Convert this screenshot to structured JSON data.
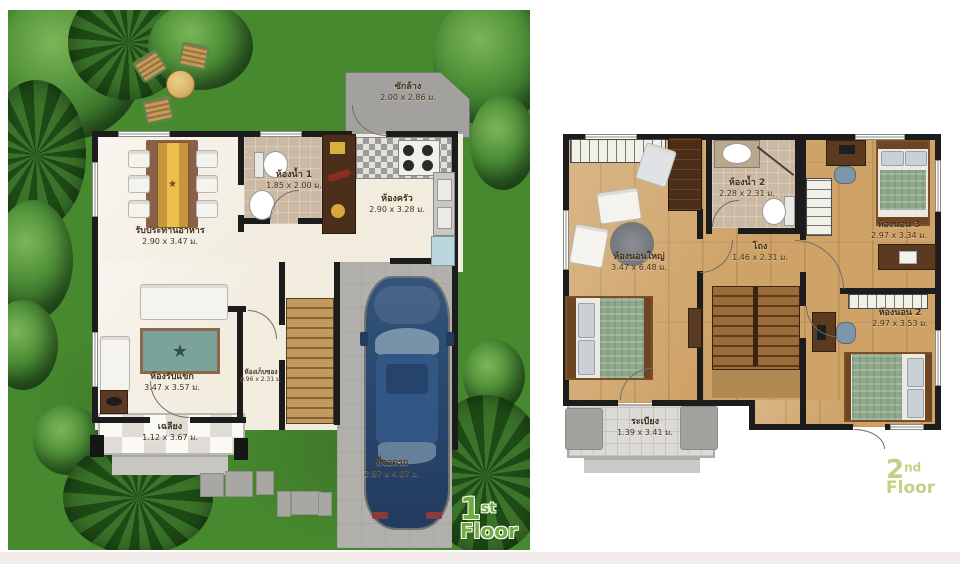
{
  "title": "House floor plans",
  "colors": {
    "garden_green": "#47892f",
    "tree_dark": "#2c5a1f",
    "wall_black": "#1c1c1c",
    "wood_floor_tan": "#cfa368",
    "cream_floor": "#f2ecdf",
    "bath_tile_beige": "#cbb9a3",
    "concrete_gray": "#b2b0ad",
    "car_blue": "#2b4a70",
    "label_brown": "#46311a",
    "floor1_tag_green": "#71ad3e",
    "floor2_tag_green": "#c2d284"
  },
  "floor1": {
    "tag": {
      "number": "1",
      "ordinal": "st",
      "word": "Floor"
    },
    "rooms": {
      "laundry": {
        "name": "ซักล้าง",
        "dims": "2.00 x 2.86 ม."
      },
      "bath1": {
        "name": "ห้องน้ำ 1",
        "dims": "1.85 x 2.00 ม."
      },
      "kitchen": {
        "name": "ห้องครัว",
        "dims": "2.90 x 3.28 ม."
      },
      "dining": {
        "name": "รับประทานอาหาร",
        "dims": "2.90 x 3.47 ม."
      },
      "living": {
        "name": "ห้องรับแขก",
        "dims": "3.47 x 3.57 ม."
      },
      "storage": {
        "name": "ห้องเก็บของ",
        "dims": "0.96 x 2.31 ม."
      },
      "terrace": {
        "name": "เฉลียง",
        "dims": "1.12 x 3.67 ม."
      },
      "carport": {
        "name": "ที่จอดรถ",
        "dims": "2.97 x 4.07 ม."
      }
    }
  },
  "floor2": {
    "tag": {
      "number": "2",
      "ordinal": "nd",
      "word": "Floor"
    },
    "rooms": {
      "master": {
        "name": "ห้องนอนใหญ่",
        "dims": "3.47 x 6.48 ม."
      },
      "bath2": {
        "name": "ห้องน้ำ 2",
        "dims": "2.28 x 2.31 ม."
      },
      "bed3": {
        "name": "ห้องนอน 3",
        "dims": "2.97 x 3.34 ม."
      },
      "hall": {
        "name": "โถง",
        "dims": "1.46 x 2.31 ม."
      },
      "bed2": {
        "name": "ห้องนอน 2",
        "dims": "2.97 x 3.53 ม."
      },
      "balcony": {
        "name": "ระเบียง",
        "dims": "1.39 x 3.41 ม."
      }
    }
  }
}
